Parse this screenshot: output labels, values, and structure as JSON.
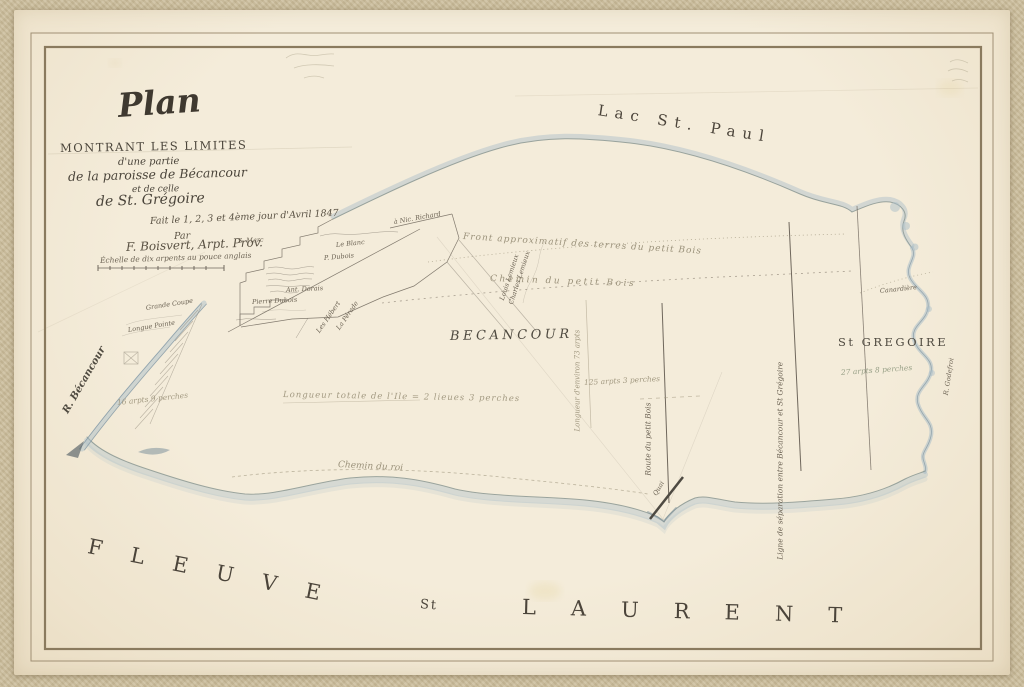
{
  "sheet": {
    "kind": "hand-drawn cadastral survey plan, 1847",
    "colors": {
      "paper": "#f1e8d5",
      "canvas_border": "#cdbf9e",
      "ink": "#5f5748",
      "water_wash": "#a9bdc8",
      "pencil": "#a39a82"
    }
  },
  "title_block": {
    "plan": "Plan",
    "sub1": "MONTRANT LES LIMITES",
    "sub2": "d'une partie",
    "sub3": "de la paroisse de Bécancour",
    "sub4": "et de celle",
    "sub5": "de St. Grégoire",
    "made": "Fait le 1, 2, 3 et 4ème jour d'Avril 1847",
    "par": "Par",
    "author": "F. Boisvert, Arpt. Prov.",
    "scale": "Échelle de dix arpents au pouce anglais"
  },
  "map_labels": [
    {
      "id": "label-lac-st-paul",
      "text": "Lac St. Paul",
      "x": 598,
      "y": 103,
      "rot": 9,
      "cls": "caps-water"
    },
    {
      "id": "label-fleuve",
      "text": "FLEUVE",
      "x": 88,
      "y": 536,
      "rot": 11.5,
      "cls": "caps-river"
    },
    {
      "id": "label-st",
      "text": "St",
      "x": 420,
      "y": 598,
      "rot": 5,
      "cls": "caps-river-sm"
    },
    {
      "id": "label-laurent",
      "text": "LAURENT",
      "x": 522,
      "y": 597,
      "rot": 1.5,
      "cls": "caps-river2"
    },
    {
      "id": "label-region-becancour",
      "text": "BECANCOUR",
      "x": 450,
      "y": 330,
      "rot": -1,
      "cls": "caps-region"
    },
    {
      "id": "label-region-st-gregoire",
      "text": "St GREGOIRE",
      "x": 838,
      "y": 337,
      "rot": 0,
      "cls": "caps-region-sm"
    },
    {
      "id": "label-r-becancour",
      "text": "R. Bécancour",
      "x": 66,
      "y": 408,
      "rot": -60,
      "cls": "script-river"
    },
    {
      "id": "label-r-godefroi",
      "text": "R. Godefroi",
      "x": 946,
      "y": 392,
      "rot": -81,
      "cls": "script-xs"
    },
    {
      "id": "label-canardiere",
      "text": "Canardière",
      "x": 880,
      "y": 288,
      "rot": -6,
      "cls": "script-xs"
    },
    {
      "id": "label-front-approximatif",
      "text": "Front approximatif des terres du petit Bois",
      "x": 463,
      "y": 233,
      "rot": 3.5,
      "cls": "pencil-script ls1"
    },
    {
      "id": "label-chemin-petit-bois",
      "text": "Chemin du petit Bois",
      "x": 490,
      "y": 275,
      "rot": 2,
      "cls": "pencil-script ls2"
    },
    {
      "id": "label-chemin-du-roi",
      "text": "Chemin du roi",
      "x": 338,
      "y": 461,
      "rot": 3,
      "cls": "pencil-script"
    },
    {
      "id": "label-longueur-totale",
      "text": "Longueur totale de l'Ile = 2 lieues 3 perches",
      "x": 283,
      "y": 391,
      "rot": 1,
      "cls": "pencil"
    },
    {
      "id": "label-125-arpents",
      "text": "125 arpts 3 perches",
      "x": 584,
      "y": 379,
      "rot": -3,
      "cls": "pencil-sm"
    },
    {
      "id": "label-27-arpents",
      "text": "27 arpts 8 perches",
      "x": 841,
      "y": 369,
      "rot": -4,
      "cls": "pencil-green"
    },
    {
      "id": "label-16-arpents",
      "text": "16 arpts 9 perches",
      "x": 117,
      "y": 399,
      "rot": -6,
      "cls": "pencil-sm"
    },
    {
      "id": "label-longueur-environ",
      "text": "Longueur d'environ 73 arpts",
      "x": 578,
      "y": 428,
      "rot": -90,
      "cls": "pencil-vert"
    },
    {
      "id": "label-ligne-separation",
      "text": "Ligne de séparation entre Bécancour et St Grégoire",
      "x": 780,
      "y": 556,
      "rot": -90,
      "cls": "script-vert"
    },
    {
      "id": "label-route-petit-bois",
      "text": "Route du petit Bois",
      "x": 648,
      "y": 472,
      "rot": -90,
      "cls": "script-vert"
    },
    {
      "id": "label-quai",
      "text": "Quai",
      "x": 655,
      "y": 492,
      "rot": -60,
      "cls": "script-xs"
    },
    {
      "id": "label-a-nic-richard",
      "text": "à Nic. Richard",
      "x": 394,
      "y": 219,
      "rot": -10,
      "cls": "script-xs"
    },
    {
      "id": "label-s-marc",
      "text": "S. Marc",
      "x": 238,
      "y": 238,
      "rot": -3,
      "cls": "script-xs"
    },
    {
      "id": "label-le-blanc",
      "text": "Le Blanc",
      "x": 336,
      "y": 242,
      "rot": -6,
      "cls": "script-xs"
    },
    {
      "id": "label-p-dubois",
      "text": "P. Dubois",
      "x": 324,
      "y": 255,
      "rot": -5,
      "cls": "script-xs"
    },
    {
      "id": "label-ant-dorais",
      "text": "Ant. Dorais",
      "x": 286,
      "y": 287,
      "rot": -3,
      "cls": "script-xs"
    },
    {
      "id": "label-pierre-dubois",
      "text": "Pierre Dubois",
      "x": 252,
      "y": 299,
      "rot": -3,
      "cls": "script-xs"
    },
    {
      "id": "label-la-perade",
      "text": "La Pérade",
      "x": 338,
      "y": 326,
      "rot": -55,
      "cls": "script-xs"
    },
    {
      "id": "label-les-hebert",
      "text": "Les Hébert",
      "x": 318,
      "y": 329,
      "rot": -55,
      "cls": "script-xs"
    },
    {
      "id": "label-louis-lemieux",
      "text": "Louis Lemieux",
      "x": 502,
      "y": 297,
      "rot": -72,
      "cls": "script-xs"
    },
    {
      "id": "label-charles-lemieux",
      "text": "Charles Lemieux",
      "x": 511,
      "y": 301,
      "rot": -72,
      "cls": "script-xs"
    },
    {
      "id": "label-grande-coupe",
      "text": "Grande Coupe",
      "x": 146,
      "y": 305,
      "rot": -9,
      "cls": "script-xs"
    },
    {
      "id": "label-longue-pointe",
      "text": "Longue Pointe",
      "x": 128,
      "y": 327,
      "rot": -9,
      "cls": "script-xs"
    }
  ]
}
